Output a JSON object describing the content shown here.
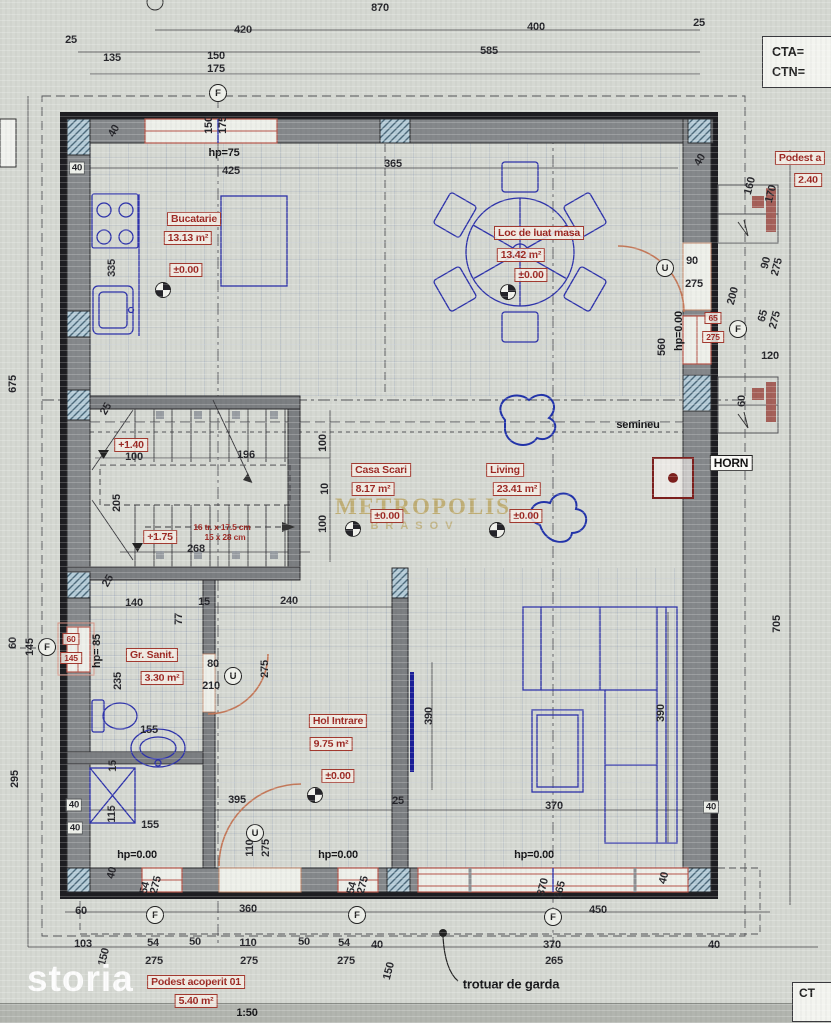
{
  "title_block": {
    "cta": "CTA=",
    "ctn": "CTN=",
    "ct_partial": "CT"
  },
  "watermarks": {
    "storia": "storia",
    "brand": "METROPOLIS",
    "brand_sub": "BRASOV"
  },
  "scale": "1:50",
  "rooms": [
    {
      "name": "Bucatarie",
      "area": "13.13 m²",
      "level": "±0.00"
    },
    {
      "name": "Loc de luat masa",
      "area": "13.42 m²",
      "level": "±0.00"
    },
    {
      "name": "Casa Scari",
      "area": "8.17 m²",
      "level": "±0.00"
    },
    {
      "name": "Living",
      "area": "23.41 m²",
      "level": "±0.00"
    },
    {
      "name": "Gr. Sanit.",
      "area": "3.30 m²",
      "level": ""
    },
    {
      "name": "Hol Intrare",
      "area": "9.75 m²",
      "level": "±0.00"
    },
    {
      "name": "Podest acoperit 01",
      "area": "5.40 m²",
      "level": ""
    },
    {
      "name": "Podest a",
      "area": "2.40",
      "level": ""
    }
  ],
  "stair_note": [
    "16 tr. x 17.5 cm",
    "15 x 28 cm"
  ],
  "labels": [
    {
      "t": "870",
      "x": 380,
      "y": 8
    },
    {
      "t": "420",
      "x": 243,
      "y": 30
    },
    {
      "t": "400",
      "x": 536,
      "y": 27
    },
    {
      "t": "25",
      "x": 71,
      "y": 40
    },
    {
      "t": "25",
      "x": 699,
      "y": 23
    },
    {
      "t": "135",
      "x": 112,
      "y": 58
    },
    {
      "t": "150",
      "x": 216,
      "y": 56
    },
    {
      "t": "175",
      "x": 216,
      "y": 69
    },
    {
      "t": "585",
      "x": 489,
      "y": 51
    },
    {
      "t": "150",
      "x": 209,
      "y": 125,
      "r": -90
    },
    {
      "t": "175",
      "x": 223,
      "y": 125,
      "r": -90
    },
    {
      "t": "425",
      "x": 231,
      "y": 171
    },
    {
      "t": "365",
      "x": 393,
      "y": 164
    },
    {
      "t": "40",
      "x": 700,
      "y": 160,
      "r": -60
    },
    {
      "t": "40",
      "x": 77,
      "y": 168,
      "k": "dimw"
    },
    {
      "t": "40",
      "x": 114,
      "y": 131,
      "r": -60
    },
    {
      "t": "335",
      "x": 112,
      "y": 268,
      "r": -90
    },
    {
      "t": "675",
      "x": 13,
      "y": 384,
      "r": -90
    },
    {
      "t": "160",
      "x": 750,
      "y": 186,
      "r": -75
    },
    {
      "t": "170",
      "x": 771,
      "y": 194,
      "r": -75
    },
    {
      "t": "90",
      "x": 766,
      "y": 263,
      "r": -75
    },
    {
      "t": "275",
      "x": 777,
      "y": 267,
      "r": -75
    },
    {
      "t": "200",
      "x": 733,
      "y": 296,
      "r": -75
    },
    {
      "t": "65",
      "x": 763,
      "y": 316,
      "r": -75
    },
    {
      "t": "275",
      "x": 775,
      "y": 320,
      "r": -75
    },
    {
      "t": "120",
      "x": 770,
      "y": 356
    },
    {
      "t": "60",
      "x": 742,
      "y": 401,
      "r": -90
    },
    {
      "t": "90",
      "x": 692,
      "y": 261
    },
    {
      "t": "275",
      "x": 694,
      "y": 284
    },
    {
      "t": "560",
      "x": 662,
      "y": 347,
      "r": -90
    },
    {
      "t": "100",
      "x": 134,
      "y": 457
    },
    {
      "t": "196",
      "x": 246,
      "y": 455
    },
    {
      "t": "205",
      "x": 117,
      "y": 503,
      "r": -90
    },
    {
      "t": "268",
      "x": 196,
      "y": 549
    },
    {
      "t": "100",
      "x": 323,
      "y": 443,
      "r": -90
    },
    {
      "t": "10",
      "x": 325,
      "y": 489,
      "r": -90
    },
    {
      "t": "100",
      "x": 323,
      "y": 524,
      "r": -90
    },
    {
      "t": "25",
      "x": 106,
      "y": 409,
      "r": -60
    },
    {
      "t": "25",
      "x": 108,
      "y": 581,
      "r": -60
    },
    {
      "t": "140",
      "x": 134,
      "y": 603
    },
    {
      "t": "15",
      "x": 204,
      "y": 602
    },
    {
      "t": "240",
      "x": 289,
      "y": 601
    },
    {
      "t": "77",
      "x": 179,
      "y": 619,
      "r": -90
    },
    {
      "t": "235",
      "x": 118,
      "y": 681,
      "r": -90
    },
    {
      "t": "80",
      "x": 213,
      "y": 664
    },
    {
      "t": "210",
      "x": 211,
      "y": 686
    },
    {
      "t": "275",
      "x": 265,
      "y": 669,
      "r": -90
    },
    {
      "t": "155",
      "x": 149,
      "y": 730
    },
    {
      "t": "15",
      "x": 113,
      "y": 766,
      "r": -90
    },
    {
      "t": "115",
      "x": 112,
      "y": 814,
      "r": -90
    },
    {
      "t": "155",
      "x": 150,
      "y": 825
    },
    {
      "t": "40",
      "x": 74,
      "y": 805,
      "k": "dimw"
    },
    {
      "t": "40",
      "x": 75,
      "y": 828,
      "k": "dimw"
    },
    {
      "t": "60",
      "x": 13,
      "y": 643,
      "r": -90
    },
    {
      "t": "145",
      "x": 30,
      "y": 647,
      "r": -90
    },
    {
      "t": "395",
      "x": 237,
      "y": 800
    },
    {
      "t": "110",
      "x": 250,
      "y": 848,
      "r": -90
    },
    {
      "t": "275",
      "x": 266,
      "y": 848,
      "r": -90
    },
    {
      "t": "25",
      "x": 398,
      "y": 801
    },
    {
      "t": "390",
      "x": 429,
      "y": 716,
      "r": -90
    },
    {
      "t": "390",
      "x": 661,
      "y": 713,
      "r": -90
    },
    {
      "t": "370",
      "x": 554,
      "y": 806
    },
    {
      "t": "40",
      "x": 711,
      "y": 807,
      "k": "dimw"
    },
    {
      "t": "705",
      "x": 777,
      "y": 624,
      "r": -90
    },
    {
      "t": "40",
      "x": 664,
      "y": 878,
      "r": -75
    },
    {
      "t": "295",
      "x": 15,
      "y": 779,
      "r": -90
    },
    {
      "t": "60",
      "x": 81,
      "y": 911
    },
    {
      "t": "360",
      "x": 248,
      "y": 909
    },
    {
      "t": "450",
      "x": 598,
      "y": 910
    },
    {
      "t": "103",
      "x": 83,
      "y": 944
    },
    {
      "t": "150",
      "x": 104,
      "y": 957,
      "r": -75
    },
    {
      "t": "54",
      "x": 153,
      "y": 943
    },
    {
      "t": "275",
      "x": 154,
      "y": 961
    },
    {
      "t": "50",
      "x": 195,
      "y": 942
    },
    {
      "t": "110",
      "x": 248,
      "y": 943
    },
    {
      "t": "275",
      "x": 249,
      "y": 961
    },
    {
      "t": "50",
      "x": 304,
      "y": 942
    },
    {
      "t": "54",
      "x": 344,
      "y": 943
    },
    {
      "t": "275",
      "x": 346,
      "y": 961
    },
    {
      "t": "40",
      "x": 377,
      "y": 945
    },
    {
      "t": "150",
      "x": 389,
      "y": 971,
      "r": -75
    },
    {
      "t": "54",
      "x": 145,
      "y": 888,
      "r": -75
    },
    {
      "t": "275",
      "x": 156,
      "y": 885,
      "r": -75
    },
    {
      "t": "54",
      "x": 352,
      "y": 888,
      "r": -75
    },
    {
      "t": "275",
      "x": 363,
      "y": 885,
      "r": -75
    },
    {
      "t": "370",
      "x": 543,
      "y": 887,
      "r": -75
    },
    {
      "t": "265",
      "x": 560,
      "y": 890,
      "r": -75
    },
    {
      "t": "370",
      "x": 552,
      "y": 945
    },
    {
      "t": "265",
      "x": 554,
      "y": 961
    },
    {
      "t": "40",
      "x": 714,
      "y": 945
    },
    {
      "t": "40",
      "x": 112,
      "y": 873,
      "r": -75
    },
    {
      "t": "Bucatarie",
      "x": 194,
      "y": 219,
      "k": "rbox"
    },
    {
      "t": "13.13 m²",
      "x": 188,
      "y": 238,
      "k": "rbox"
    },
    {
      "t": "±0.00",
      "x": 186,
      "y": 270,
      "k": "rbox"
    },
    {
      "t": "Loc de luat masa",
      "x": 539,
      "y": 233,
      "k": "rbox"
    },
    {
      "t": "13.42 m²",
      "x": 521,
      "y": 255,
      "k": "rbox"
    },
    {
      "t": "±0.00",
      "x": 531,
      "y": 275,
      "k": "rbox"
    },
    {
      "t": "Casa Scari",
      "x": 381,
      "y": 470,
      "k": "rbox"
    },
    {
      "t": "8.17 m²",
      "x": 373,
      "y": 489,
      "k": "rbox"
    },
    {
      "t": "±0.00",
      "x": 387,
      "y": 516,
      "k": "rbox"
    },
    {
      "t": "Living",
      "x": 505,
      "y": 470,
      "k": "rbox"
    },
    {
      "t": "23.41 m²",
      "x": 517,
      "y": 489,
      "k": "rbox"
    },
    {
      "t": "±0.00",
      "x": 526,
      "y": 516,
      "k": "rbox"
    },
    {
      "t": "Gr. Sanit.",
      "x": 152,
      "y": 655,
      "k": "rbox"
    },
    {
      "t": "3.30 m²",
      "x": 162,
      "y": 678,
      "k": "rbox"
    },
    {
      "t": "Hol Intrare",
      "x": 338,
      "y": 721,
      "k": "rbox"
    },
    {
      "t": "9.75 m²",
      "x": 331,
      "y": 744,
      "k": "rbox"
    },
    {
      "t": "±0.00",
      "x": 338,
      "y": 776,
      "k": "rbox"
    },
    {
      "t": "+1.40",
      "x": 131,
      "y": 445,
      "k": "rbox"
    },
    {
      "t": "+1.75",
      "x": 160,
      "y": 537,
      "k": "rbox"
    },
    {
      "t": "Podest acoperit 01",
      "x": 196,
      "y": 982,
      "k": "rbox"
    },
    {
      "t": "5.40 m²",
      "x": 196,
      "y": 1001,
      "k": "rbox"
    },
    {
      "t": "Podest a",
      "x": 800,
      "y": 158,
      "k": "rbox"
    },
    {
      "t": "2.40",
      "x": 808,
      "y": 180,
      "k": "rbox"
    },
    {
      "t": "60",
      "x": 71,
      "y": 639,
      "k": "rbox",
      "fs": 8.5
    },
    {
      "t": "145",
      "x": 71,
      "y": 658,
      "k": "rbox",
      "fs": 8.5
    },
    {
      "t": "65",
      "x": 713,
      "y": 318,
      "k": "rbox",
      "fs": 8.5
    },
    {
      "t": "275",
      "x": 713,
      "y": 337,
      "k": "rbox",
      "fs": 8.5
    },
    {
      "t": "16 tr. x 17.5 cm",
      "x": 222,
      "y": 527,
      "k": "red"
    },
    {
      "t": "15 x 28 cm",
      "x": 225,
      "y": 537,
      "k": "red"
    },
    {
      "t": "hp=75",
      "x": 224,
      "y": 153,
      "k": "ann"
    },
    {
      "t": "hp=0.00",
      "x": 679,
      "y": 331,
      "r": -90,
      "k": "ann"
    },
    {
      "t": "hp= 85",
      "x": 97,
      "y": 651,
      "r": -90,
      "k": "ann"
    },
    {
      "t": "semineu",
      "x": 638,
      "y": 425,
      "k": "ann"
    },
    {
      "t": "hp=0.00",
      "x": 137,
      "y": 855,
      "k": "ann"
    },
    {
      "t": "hp=0.00",
      "x": 338,
      "y": 855,
      "k": "ann"
    },
    {
      "t": "hp=0.00",
      "x": 534,
      "y": 855,
      "k": "ann"
    },
    {
      "t": "trotuar de garda",
      "x": 511,
      "y": 984,
      "k": "ann",
      "fs": 13
    },
    {
      "t": "1:50",
      "x": 247,
      "y": 1013,
      "k": "ann"
    },
    {
      "t": "HORN",
      "x": 731,
      "y": 463,
      "k": "annb"
    }
  ],
  "axis_markers": [
    {
      "letter": "F",
      "x": 218,
      "y": 93
    },
    {
      "letter": "F",
      "x": 47,
      "y": 647
    },
    {
      "letter": "F",
      "x": 738,
      "y": 329
    },
    {
      "letter": "F",
      "x": 155,
      "y": 915
    },
    {
      "letter": "F",
      "x": 357,
      "y": 915
    },
    {
      "letter": "F",
      "x": 553,
      "y": 917
    },
    {
      "letter": "U",
      "x": 665,
      "y": 268
    },
    {
      "letter": "U",
      "x": 233,
      "y": 676
    },
    {
      "letter": "U",
      "x": 255,
      "y": 833
    }
  ],
  "crosshairs": [
    [
      163,
      290
    ],
    [
      508,
      292
    ],
    [
      353,
      529
    ],
    [
      497,
      530
    ],
    [
      315,
      795
    ]
  ]
}
